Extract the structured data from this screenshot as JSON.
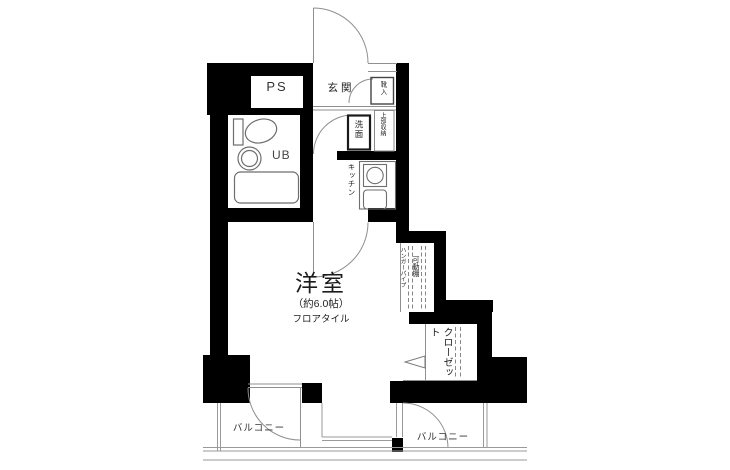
{
  "labels": {
    "pipe_space": "PS",
    "entrance": "玄関",
    "shoe_cabinet": "靴入",
    "washbasin": "洗面",
    "upper_storage": "上部収納",
    "kitchen": "キッチン",
    "unit_bath": "UB",
    "room_name": "洋室",
    "room_size": "（約6.0帖）",
    "room_floor": "フロアタイル",
    "hanger_pipe": "ハンガーパイプ",
    "movable_shelf": "可動棚",
    "closet": "クローゼット",
    "balcony_left": "バルコニー",
    "balcony_right": "バルコニー"
  },
  "colors": {
    "wall": "#000000",
    "line": "#8f8f8f",
    "rail": "#9a9a9a",
    "fixture": "#6e6e6e",
    "text": "#222222",
    "background": "#ffffff"
  }
}
